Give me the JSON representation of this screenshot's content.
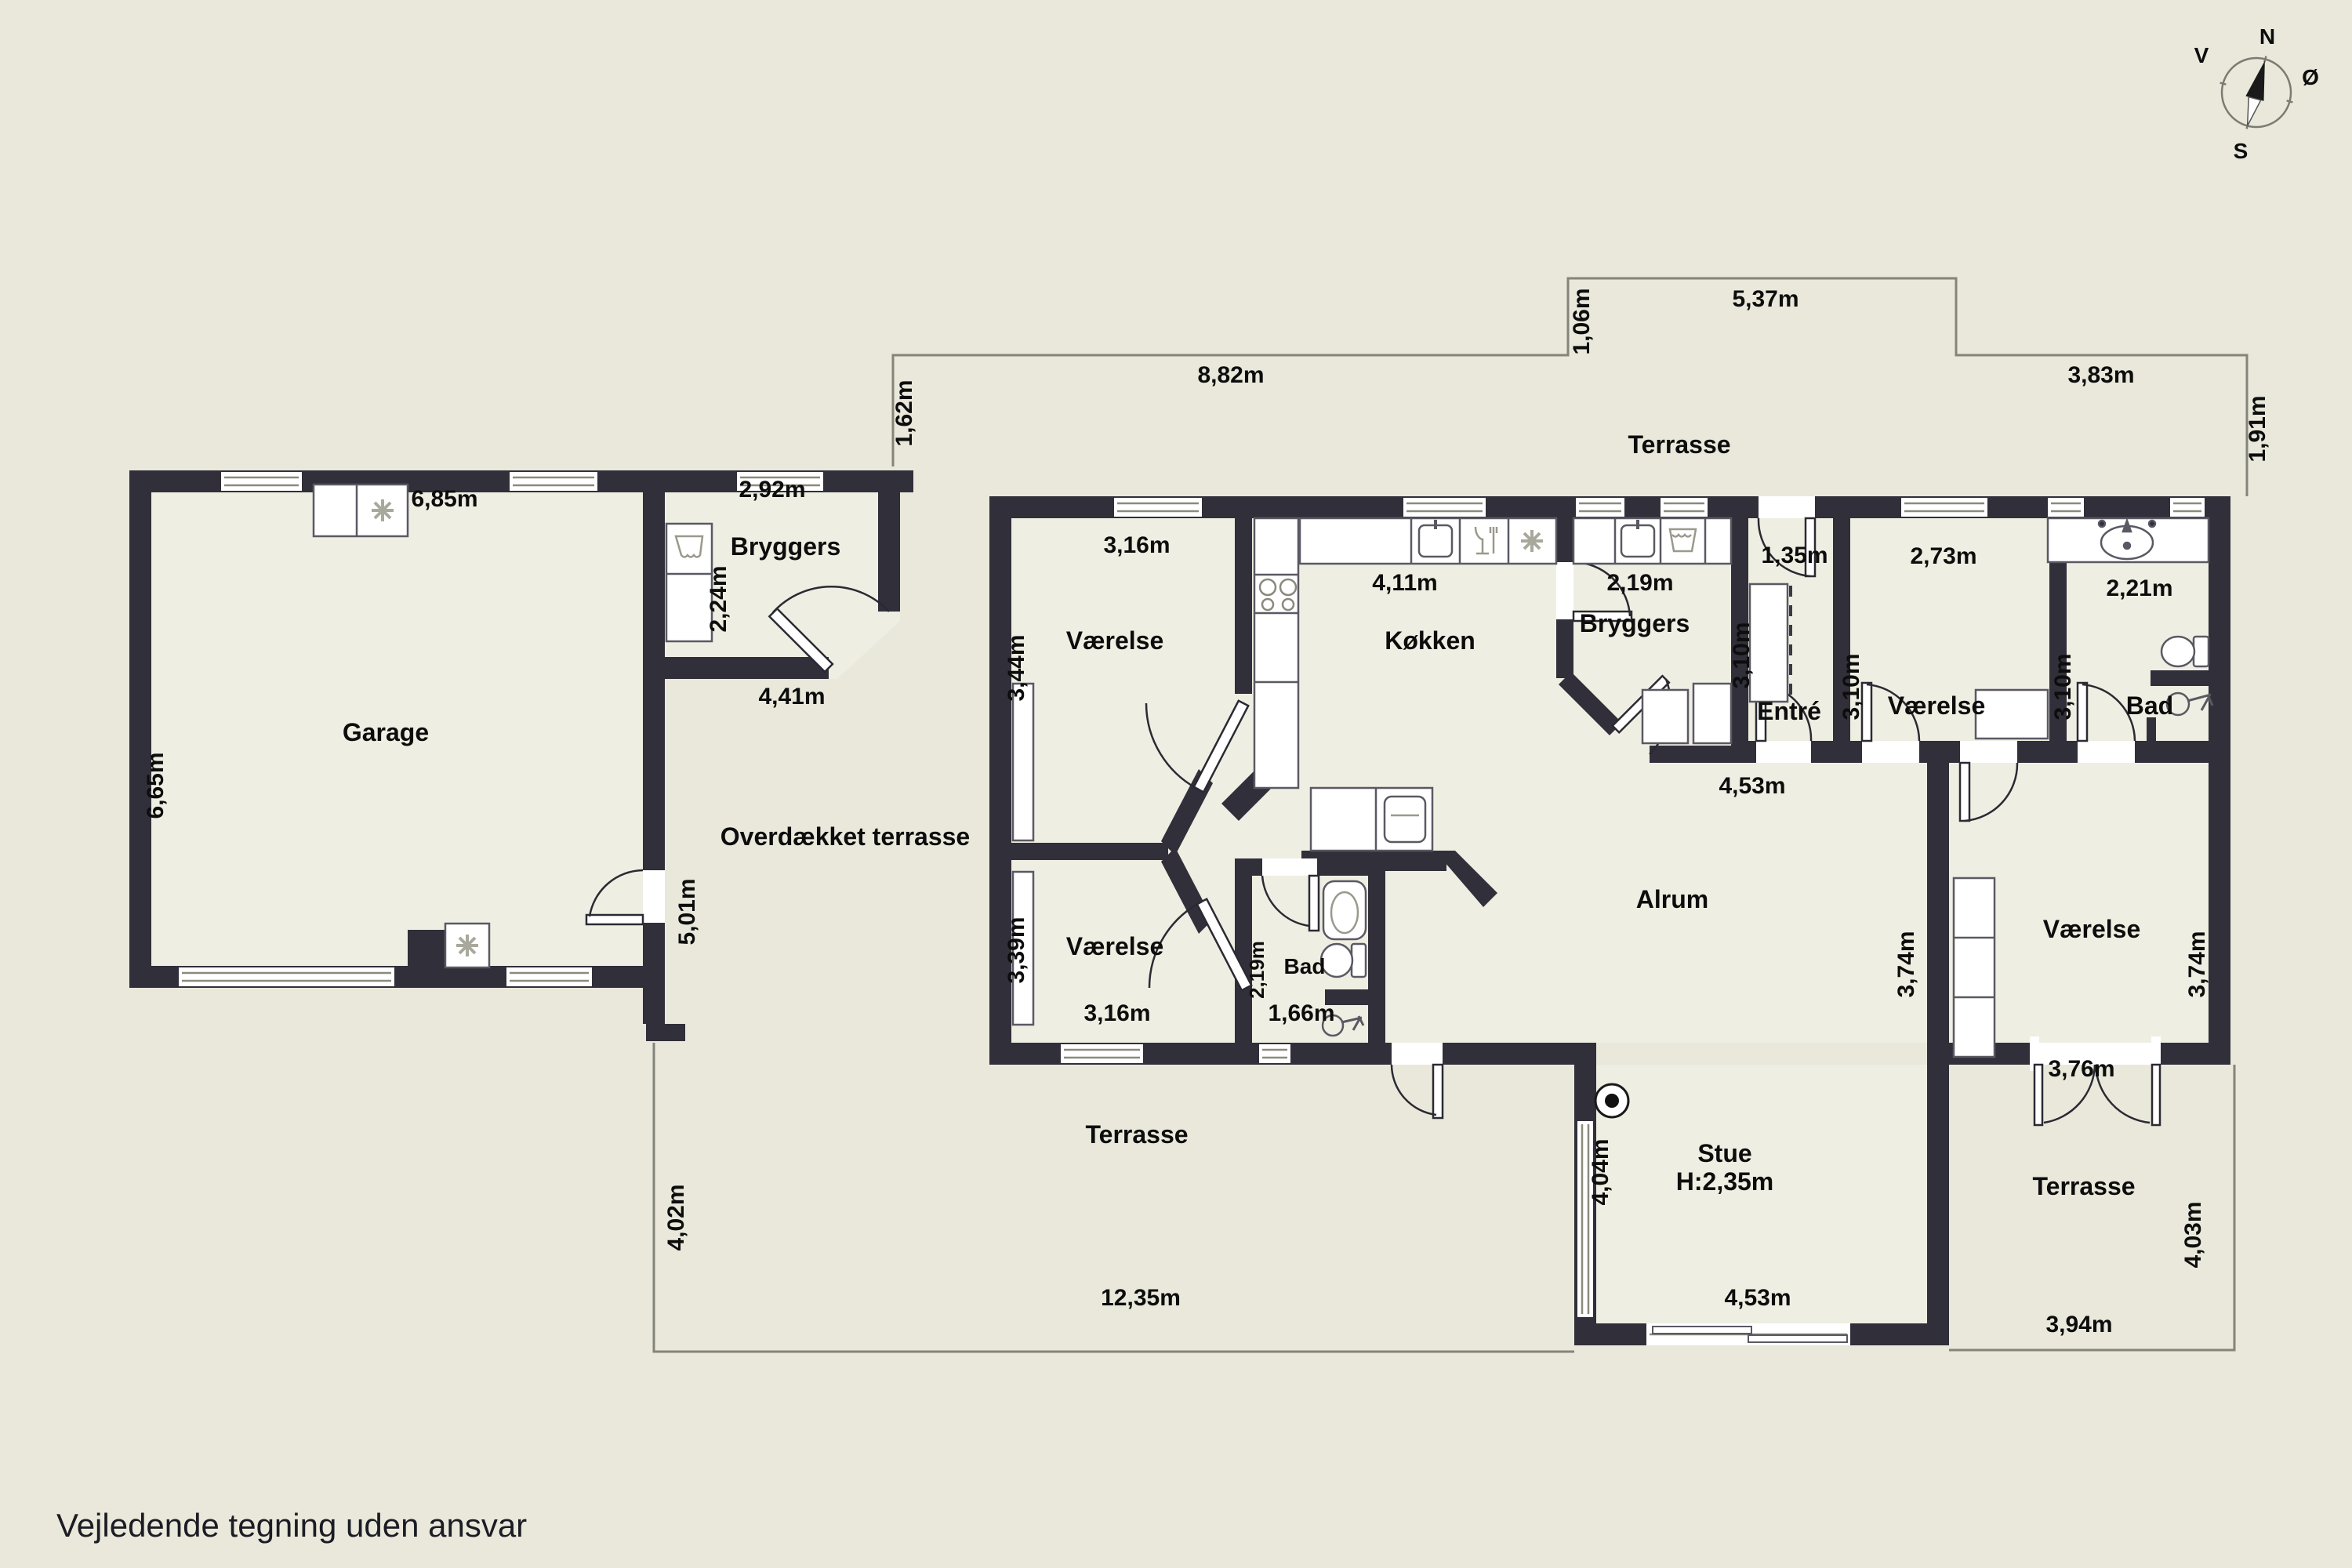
{
  "title": "Floor plan",
  "footer": {
    "disclaimer": "Vejledende tegning uden ansvar"
  },
  "compass": {
    "points": {
      "n": "N",
      "e": "Ø",
      "s": "S",
      "v": "V"
    }
  },
  "colors": {
    "background": "#e9e8db",
    "interior": "#efeee2",
    "wall": "#312f3a",
    "thin_line": "#85847a",
    "fixture_stroke": "#5a5963",
    "text": "#0d0d0d"
  },
  "rooms": {
    "garage": "Garage",
    "annex_bryggers": "Bryggers",
    "overdaekket_terrasse": "Overdækket terrasse",
    "vaerelse_nw": "Værelse",
    "koekken": "Køkken",
    "bryggers": "Bryggers",
    "entre": "Entré",
    "vaerelse_n": "Værelse",
    "bad_ne": "Bad",
    "vaerelse_sw": "Værelse",
    "bad_s": "Bad",
    "alrum": "Alrum",
    "stue": "Stue",
    "stue_height": "H:2,35m",
    "vaerelse_e": "Værelse",
    "terrasse_n": "Terrasse",
    "terrasse_sw": "Terrasse",
    "terrasse_se": "Terrasse"
  },
  "labels": {
    "garage_top": "6,85m",
    "garage_left": "6,65m",
    "annex_top": "2,92m",
    "annex_left": "2,24m",
    "annex_bottom": "4,41m",
    "ot_wall": "5,01m",
    "tn_a": "8,82m",
    "tn_b": "1,06m",
    "tn_c": "5,37m",
    "tn_d": "3,83m",
    "tn_e": "1,62m",
    "tn_f": "1,91m",
    "nw_top": "3,16m",
    "nw_left": "3,44m",
    "kk_top": "4,11m",
    "br_top": "2,19m",
    "en_top": "1,35m",
    "en_left": "3,10m",
    "vn_top": "2,73m",
    "vn_left": "3,10m",
    "bn_top": "2,21m",
    "bn_left": "3,10m",
    "row": "4,53m",
    "sw_left": "3,39m",
    "sw_bot": "3,16m",
    "bs_left": "2,19m",
    "bs_bot": "1,66m",
    "st_w": "4,04m",
    "st_s": "4,53m",
    "ve_l": "3,74m",
    "ve_r": "3,74m",
    "ve_b": "3,76m",
    "tsw_l": "4,02m",
    "tsw_b": "12,35m",
    "tse_b": "3,94m",
    "tse_r": "4,03m"
  }
}
